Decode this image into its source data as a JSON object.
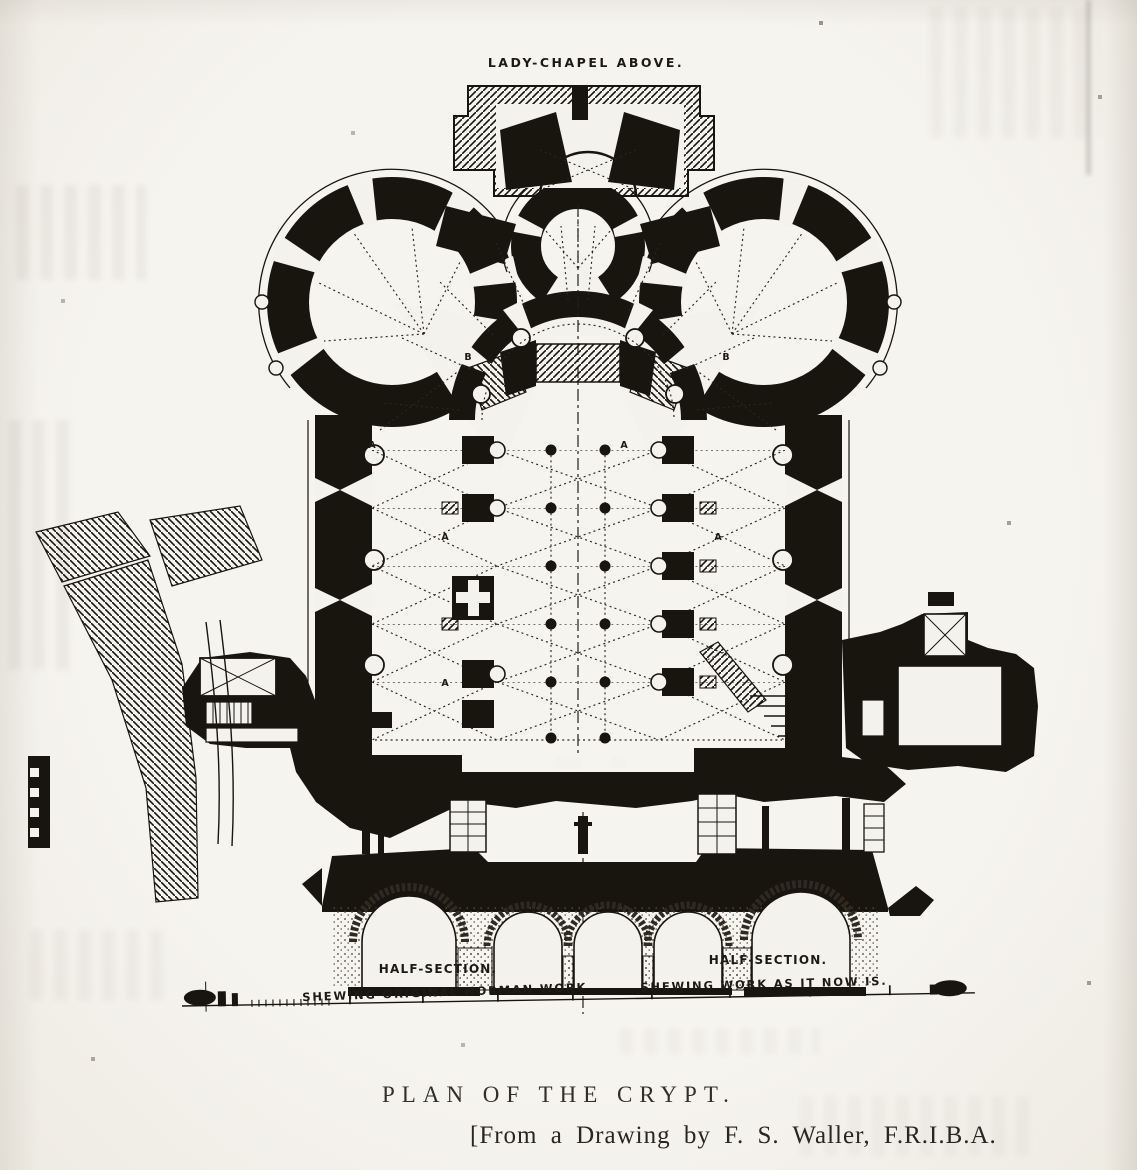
{
  "colors": {
    "paper": "#f4f2ec",
    "ink": "#18150f"
  },
  "plan": {
    "lady_chapel_label": "LADY-CHAPEL ABOVE.",
    "ref_letter_a": "A",
    "ref_letter_b": "B"
  },
  "section": {
    "left": {
      "title": "HALF-SECTION.",
      "subtitle": "SHEWING ORIGINAL NORMAN WORK."
    },
    "right": {
      "title": "HALF-SECTION.",
      "subtitle": "SHEWING WORK AS IT NOW IS."
    }
  },
  "caption": {
    "title": "PLAN OF THE CRYPT.",
    "credit": "[From a Drawing by F. S. Waller, F.R.I.B.A."
  }
}
